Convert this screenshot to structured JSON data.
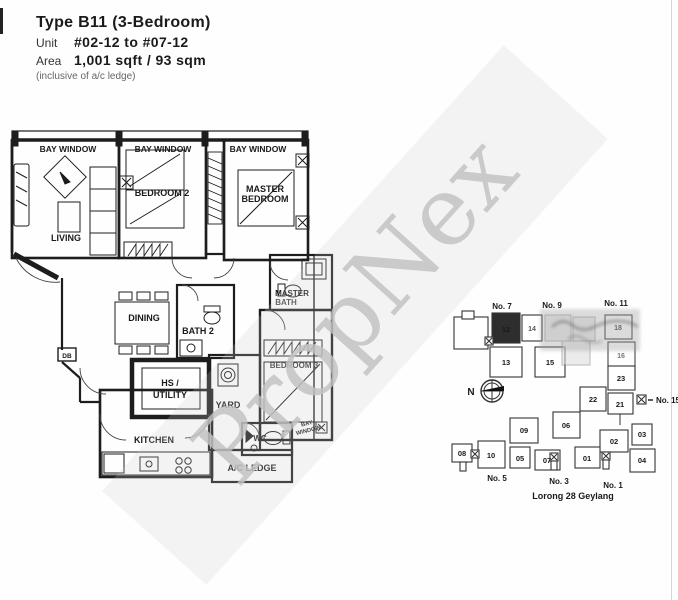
{
  "header": {
    "title": "Type B11 (3-Bedroom)",
    "unit_label": "Unit",
    "unit_value": "#02-12 to #07-12",
    "area_label": "Area",
    "area_value": "1,001 sqft / 93 sqm",
    "note": "(inclusive of a/c ledge)"
  },
  "watermark": {
    "text": "PropNex"
  },
  "floorplan": {
    "bay_window_top_1": "BAY WINDOW",
    "bay_window_top_2": "BAY WINDOW",
    "bay_window_top_3": "BAY WINDOW",
    "bay_window_right_line1": "BAY",
    "bay_window_right_line2": "WINDOW",
    "living": "LIVING",
    "bedroom2": "BEDROOM 2",
    "master_line1": "MASTER",
    "master_line2": "BEDROOM",
    "dining": "DINING",
    "bath2": "BATH 2",
    "master_bath_line1": "MASTER",
    "master_bath_line2": "BATH",
    "bedroom3": "BEDROOM 3",
    "hs_line1": "HS /",
    "hs_line2": "UTILITY",
    "yard": "YARD",
    "kitchen": "KITCHEN",
    "wc": "WC",
    "ac_ledge": "A/C LEDGE",
    "db": "DB"
  },
  "siteplan": {
    "street": "Lorong 28 Geylang",
    "compass_n": "N",
    "blocks": {
      "no7": "No. 7",
      "no9": "No. 9",
      "no11": "No. 11",
      "no15": "No. 15",
      "no5": "No. 5",
      "no3": "No. 3",
      "no1": "No. 1"
    },
    "units": {
      "u12": "12",
      "u13": "13",
      "u14": "14",
      "u15": "15",
      "u16": "16",
      "u18": "18",
      "u21": "21",
      "u22": "22",
      "u23": "23",
      "u01": "01",
      "u02": "02",
      "u03": "03",
      "u04": "04",
      "u05": "05",
      "u06": "06",
      "u07": "07",
      "u08": "08",
      "u09": "09",
      "u10": "10"
    },
    "highlight_color": "#2e2e2e"
  }
}
